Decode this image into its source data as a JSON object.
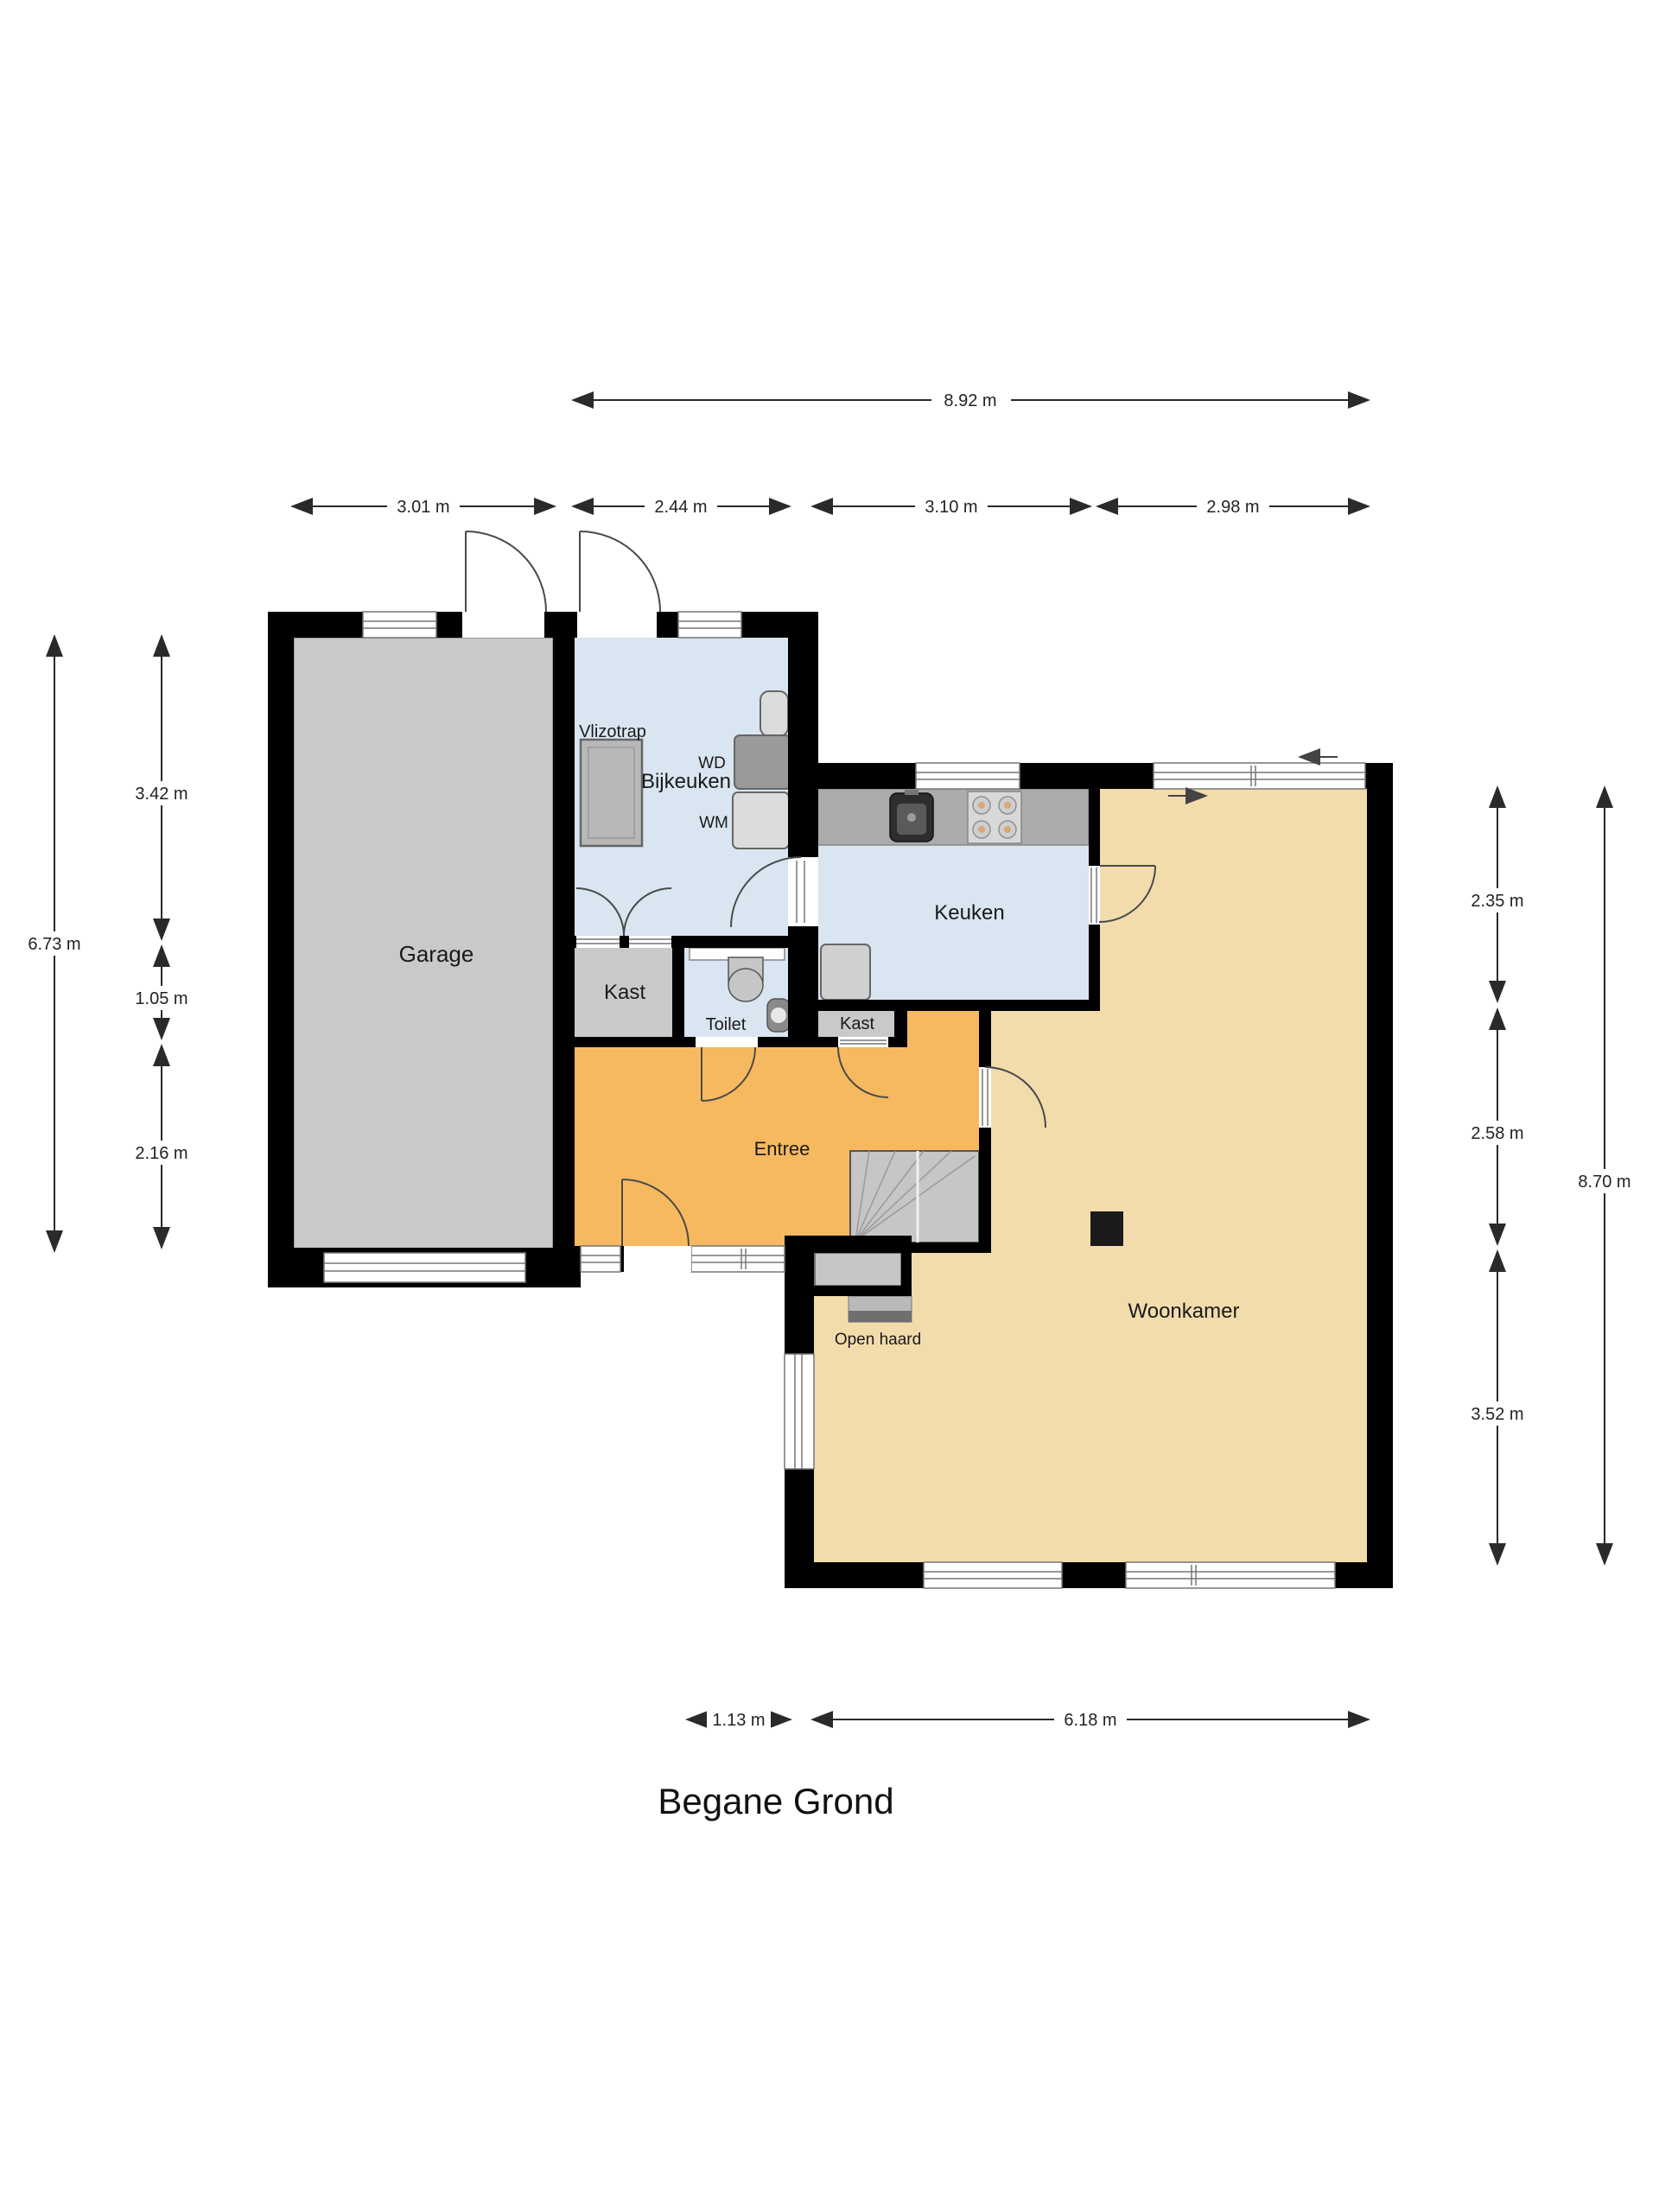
{
  "title": "Begane Grond",
  "rooms": {
    "garage": "Garage",
    "vlizotrap": "Vlizotrap",
    "bijkeuken": "Bijkeuken",
    "wd": "WD",
    "wm": "WM",
    "keuken": "Keuken",
    "kast1": "Kast",
    "toilet": "Toilet",
    "kast2": "Kast",
    "entree": "Entree",
    "open_haard": "Open haard",
    "woonkamer": "Woonkamer"
  },
  "dimensions": {
    "top_total": "8.92 m",
    "top": [
      "3.01 m",
      "2.44 m",
      "3.10 m",
      "2.98 m"
    ],
    "left_total": "6.73 m",
    "left": [
      "3.42 m",
      "1.05 m",
      "2.16 m"
    ],
    "right": [
      "2.35 m",
      "2.58 m",
      "3.52 m"
    ],
    "right_total": "8.70 m",
    "bottom": [
      "1.13 m",
      "6.18 m"
    ]
  },
  "colors": {
    "wall": "#000000",
    "garage_floor": "#C9C9C9",
    "wet_room_floor": "#D9E5F1",
    "entree_floor": "#F7B95F",
    "living_floor": "#F3DCAC",
    "counter": "#ABABAB",
    "dimension": "#2A2A2A",
    "background": "#FFFFFF"
  }
}
